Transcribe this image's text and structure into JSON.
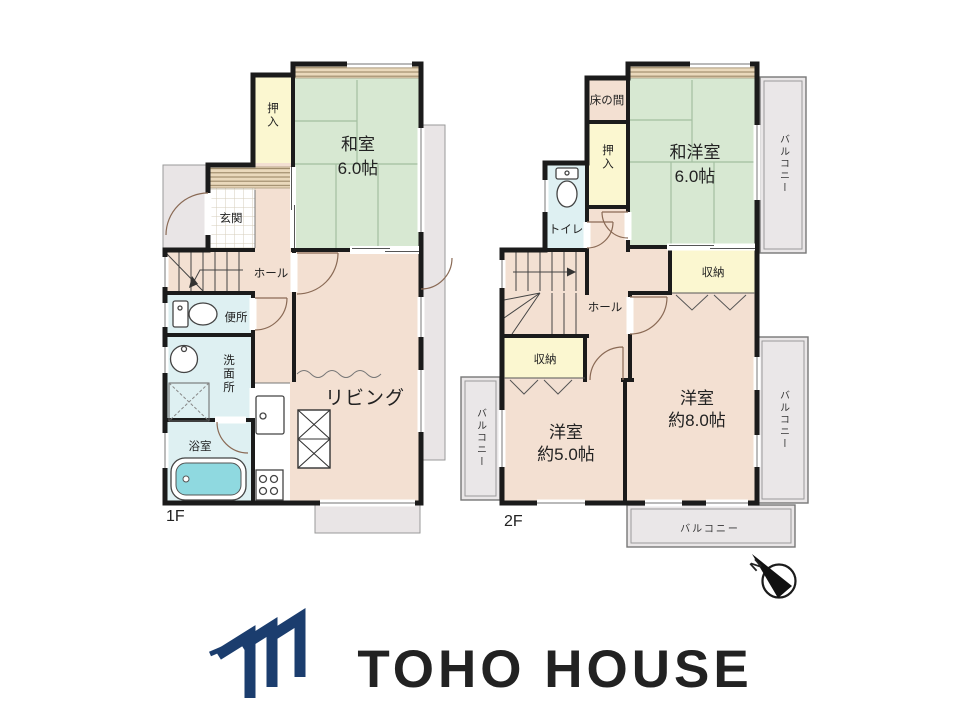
{
  "floor1": {
    "label": "1F",
    "rooms": {
      "washitsu": {
        "name": "和室",
        "size": "6.0帖"
      },
      "oshiire": "押入",
      "genkan": "玄関",
      "hall": "ホール",
      "benjo": "便所",
      "senmenjo": "洗面所",
      "yokushitsu": "浴室",
      "living": "リビング"
    }
  },
  "floor2": {
    "label": "2F",
    "rooms": {
      "tokonoma": "床の間",
      "oshiire": "押入",
      "wayoushitsu": {
        "name": "和洋室",
        "size": "6.0帖"
      },
      "toire": "トイレ",
      "hall": "ホール",
      "shunou_a": "収納",
      "shunou_b": "収納",
      "youshitsu8": {
        "name": "洋室",
        "size": "約8.0帖"
      },
      "youshitsu5": {
        "name": "洋室",
        "size": "約5.0帖"
      },
      "balcony_top_right": "バルコニー",
      "balcony_left": "バルコニー",
      "balcony_bottom_right": "バルコニー",
      "balcony_bottom": "バルコニー"
    }
  },
  "compass": {
    "north": "N"
  },
  "brand": {
    "logo_text": "TOHO HOUSE"
  },
  "colors": {
    "wall": "#1b1b1b",
    "room_beige": "#f3e0d2",
    "tatami_green": "#d7e8d2",
    "closet_yellow": "#fbf7d0",
    "wet_blue": "#def0f2",
    "bathtub_teal": "#8fd9e0",
    "balcony_gray": "#eae7e8",
    "logo_navy": "#1b3d6e"
  }
}
